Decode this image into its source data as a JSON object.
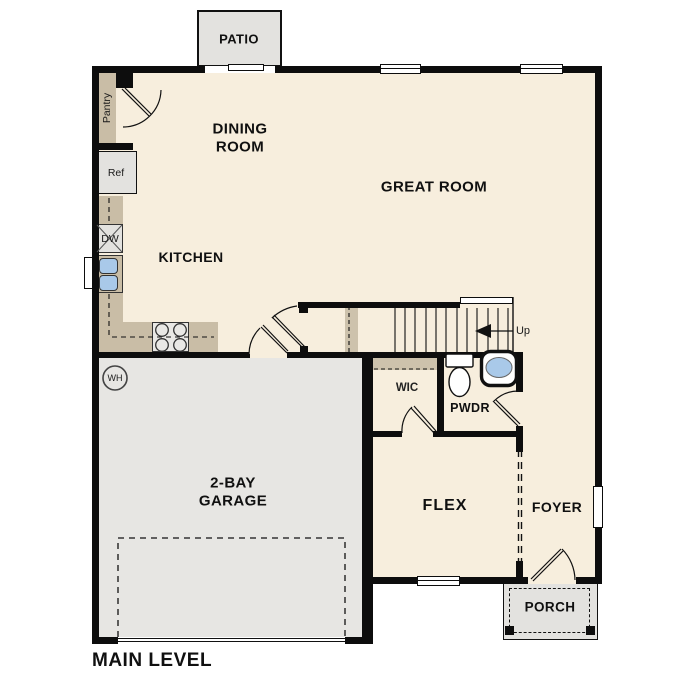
{
  "plan_title": "MAIN LEVEL",
  "labels": {
    "patio": "PATIO",
    "dining_line1": "DINING",
    "dining_line2": "ROOM",
    "great_room": "GREAT ROOM",
    "kitchen": "KITCHEN",
    "pantry": "Pantry",
    "ref": "Ref",
    "dw": "DW",
    "wh": "WH",
    "up": "Up",
    "wic": "WIC",
    "pwdr": "PWDR",
    "garage_line1": "2-BAY",
    "garage_line2": "GARAGE",
    "flex": "FLEX",
    "foyer": "FOYER",
    "porch": "PORCH"
  },
  "colors": {
    "wall": "#0d0d0d",
    "floor_cream": "#f7eedd",
    "counter_tan": "#c9bda6",
    "garage_floor": "#e7e6e3",
    "concrete_gray": "#e3e2df",
    "sink_blue": "#a9c9e9",
    "text": "#101010"
  }
}
